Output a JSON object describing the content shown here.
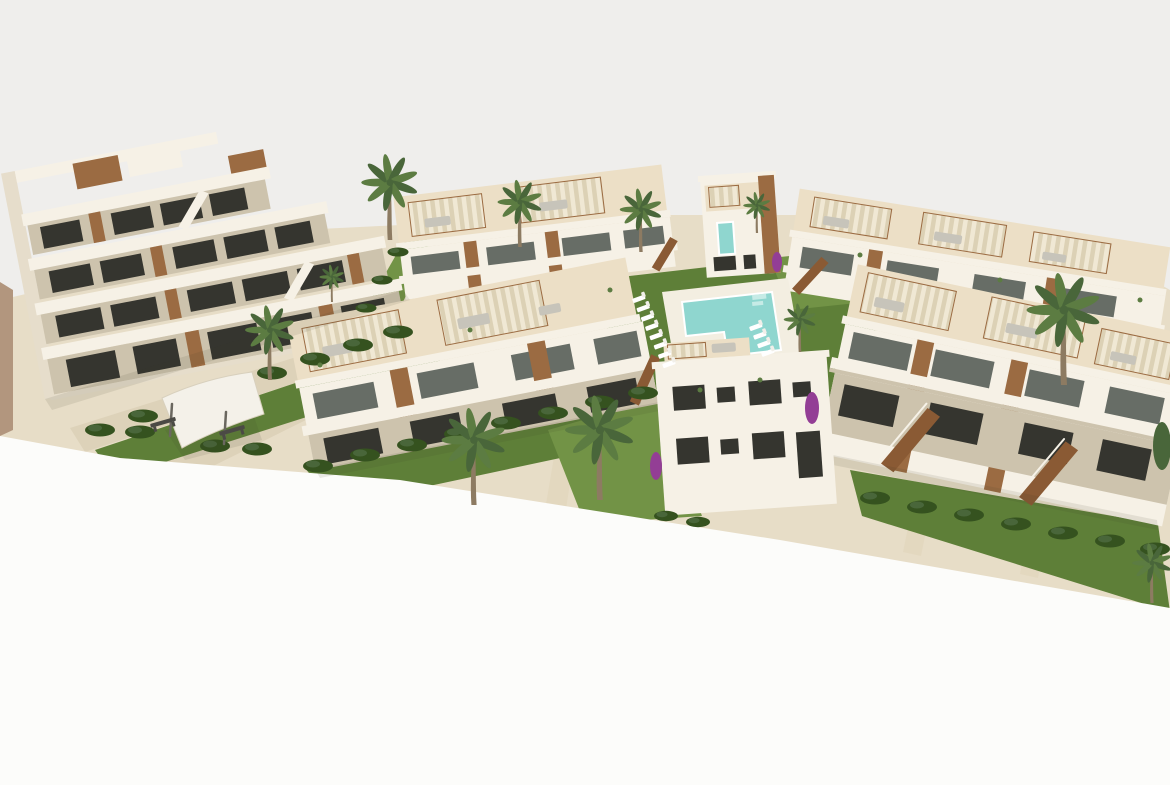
{
  "scene": {
    "medium": "3D architectural exterior render",
    "view": "aerial three-quarter view",
    "subject": "Modern Mediterranean white residential complex with stepped apartment block, townhouse rows, rooftop pergola terraces, communal pool and landscaped gardens",
    "background": "plain light-grey backdrop",
    "foreground": "white cropped ground plane"
  },
  "objects": {
    "apartment_block_left": "four-storey stepped apartment block with cascading terraces and timber accent panels",
    "townhouse_rows": 4,
    "villa_center": "white two/three-storey house with dark window openings",
    "villa_back_center": "small villa with timber panel and turquoise glass strip",
    "pool": "L-shaped turquoise communal pool with pale stone sun deck",
    "sun_loungers": 12,
    "palm_trees": 11,
    "hedges": 31,
    "pergolas": 12,
    "benches": 2,
    "bougainvillea": 3,
    "promenade": "travertine pedestrian promenade with white shade sail on posts",
    "staircases": "external timber staircases to upper units"
  },
  "colors": {
    "sky": "#efeeec",
    "paper": "#fcfcfa",
    "sand": "#e7ddc7",
    "pave": "#ddd2b9",
    "pave2": "#e3d8bf",
    "deck": "#f3eee1",
    "wall": "#f6f1e6",
    "wallsh": "#e6ddcb",
    "recess": "#cdc3ad",
    "roofc": "#ecdfc6",
    "canvas": "#f0e8d4",
    "canvasStripe": "#dcd1b5",
    "wood": "#9b6b42",
    "wood2": "#8a5a34",
    "woodLight": "#c49b72",
    "win": "#35352f",
    "glass": "#676d66",
    "grass": "#5e7f38",
    "grass2": "#729346",
    "hedge": "#35521f",
    "pool": "#8fd6cf",
    "poolStep": "#c6ebe6",
    "purple": "#933e95",
    "trunk": "#8d7b62",
    "frond": "#5c7c42",
    "frond2": "#49663a",
    "gray": "#c7c4ba",
    "dark": "#4b4a45",
    "post": "#6a675f",
    "rail": "#f6f2e8",
    "sail": "#f4f1e9",
    "sailEdge": "#d8d0bd",
    "leftWall": "#b2967e"
  }
}
